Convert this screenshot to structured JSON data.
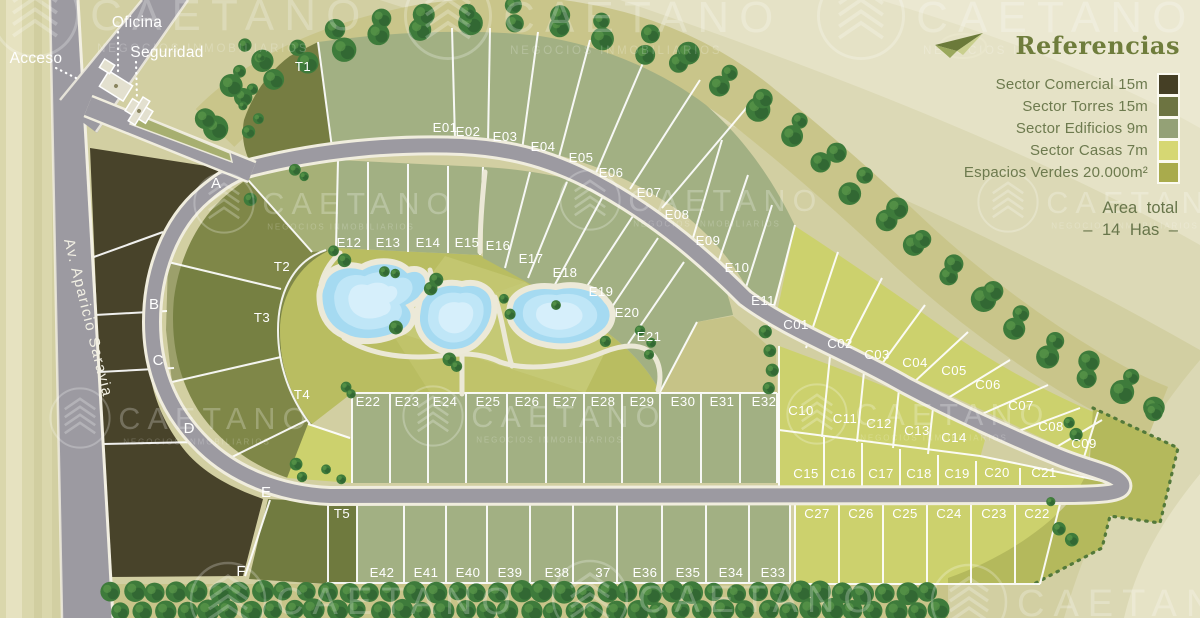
{
  "legend": {
    "title": "Referencias",
    "items": [
      {
        "label": "Sector Comercial 15m",
        "color": "#453f25"
      },
      {
        "label": "Sector Torres 15m",
        "color": "#6d7441"
      },
      {
        "label": "Sector Edificios 9m",
        "color": "#94a176"
      },
      {
        "label": "Sector Casas 7m",
        "color": "#d6d773"
      },
      {
        "label": "Espacios Verdes 20.000m²",
        "color": "#a9ab4c"
      }
    ],
    "area_line1": "Area total",
    "area_line2": "– 14 Has –"
  },
  "watermark": {
    "name": "CAETANO",
    "subtitle": "NEGOCIOS INMOBILIARIOS"
  },
  "entrance_labels": [
    {
      "text": "Acceso",
      "x": 36,
      "y": 63
    },
    {
      "text": "Oficina",
      "x": 137,
      "y": 27
    },
    {
      "text": "Seguridad",
      "x": 167,
      "y": 57
    }
  ],
  "avenue_label": {
    "text": "Av. Aparicio Saravia"
  },
  "lots": [
    {
      "id": "T1",
      "x": 303,
      "y": 71
    },
    {
      "id": "E01",
      "x": 445,
      "y": 132
    },
    {
      "id": "E02",
      "x": 468,
      "y": 136
    },
    {
      "id": "E03",
      "x": 505,
      "y": 141
    },
    {
      "id": "E04",
      "x": 543,
      "y": 151
    },
    {
      "id": "E05",
      "x": 581,
      "y": 162
    },
    {
      "id": "E06",
      "x": 611,
      "y": 177
    },
    {
      "id": "E07",
      "x": 649,
      "y": 197
    },
    {
      "id": "E08",
      "x": 677,
      "y": 219
    },
    {
      "id": "E09",
      "x": 708,
      "y": 245
    },
    {
      "id": "E10",
      "x": 737,
      "y": 272
    },
    {
      "id": "E11",
      "x": 763,
      "y": 305
    },
    {
      "id": "E12",
      "x": 349,
      "y": 247
    },
    {
      "id": "E13",
      "x": 388,
      "y": 247
    },
    {
      "id": "E14",
      "x": 428,
      "y": 247
    },
    {
      "id": "E15",
      "x": 467,
      "y": 247
    },
    {
      "id": "E16",
      "x": 498,
      "y": 250
    },
    {
      "id": "E17",
      "x": 531,
      "y": 263
    },
    {
      "id": "E18",
      "x": 565,
      "y": 277
    },
    {
      "id": "E19",
      "x": 601,
      "y": 296
    },
    {
      "id": "E20",
      "x": 627,
      "y": 317
    },
    {
      "id": "E21",
      "x": 649,
      "y": 341
    },
    {
      "id": "T2",
      "x": 282,
      "y": 271
    },
    {
      "id": "T3",
      "x": 262,
      "y": 322
    },
    {
      "id": "T4",
      "x": 302,
      "y": 399
    },
    {
      "id": "T5",
      "x": 342,
      "y": 518
    },
    {
      "id": "E22",
      "x": 368,
      "y": 406
    },
    {
      "id": "E23",
      "x": 407,
      "y": 406
    },
    {
      "id": "E24",
      "x": 445,
      "y": 406
    },
    {
      "id": "E25",
      "x": 488,
      "y": 406
    },
    {
      "id": "E26",
      "x": 527,
      "y": 406
    },
    {
      "id": "E27",
      "x": 565,
      "y": 406
    },
    {
      "id": "E28",
      "x": 603,
      "y": 406
    },
    {
      "id": "E29",
      "x": 642,
      "y": 406
    },
    {
      "id": "E30",
      "x": 683,
      "y": 406
    },
    {
      "id": "E31",
      "x": 722,
      "y": 406
    },
    {
      "id": "E32",
      "x": 764,
      "y": 406
    },
    {
      "id": "E42",
      "x": 382,
      "y": 577
    },
    {
      "id": "E41",
      "x": 426,
      "y": 577
    },
    {
      "id": "E40",
      "x": 468,
      "y": 577
    },
    {
      "id": "E39",
      "x": 510,
      "y": 577
    },
    {
      "id": "E38",
      "x": 557,
      "y": 577
    },
    {
      "id": "37",
      "x": 603,
      "y": 577
    },
    {
      "id": "E36",
      "x": 645,
      "y": 577
    },
    {
      "id": "E35",
      "x": 688,
      "y": 577
    },
    {
      "id": "E34",
      "x": 731,
      "y": 577
    },
    {
      "id": "E33",
      "x": 773,
      "y": 577
    },
    {
      "id": "C01",
      "x": 796,
      "y": 329
    },
    {
      "id": "C02",
      "x": 840,
      "y": 348
    },
    {
      "id": "C03",
      "x": 877,
      "y": 359
    },
    {
      "id": "C04",
      "x": 915,
      "y": 367
    },
    {
      "id": "C05",
      "x": 954,
      "y": 375
    },
    {
      "id": "C06",
      "x": 988,
      "y": 389
    },
    {
      "id": "C07",
      "x": 1021,
      "y": 410
    },
    {
      "id": "C08",
      "x": 1051,
      "y": 431
    },
    {
      "id": "C09",
      "x": 1084,
      "y": 448
    },
    {
      "id": "C10",
      "x": 801,
      "y": 415
    },
    {
      "id": "C11",
      "x": 845,
      "y": 423
    },
    {
      "id": "C12",
      "x": 879,
      "y": 428
    },
    {
      "id": "C13",
      "x": 917,
      "y": 435
    },
    {
      "id": "C14",
      "x": 954,
      "y": 442
    },
    {
      "id": "C15",
      "x": 806,
      "y": 478
    },
    {
      "id": "C16",
      "x": 843,
      "y": 478
    },
    {
      "id": "C17",
      "x": 881,
      "y": 478
    },
    {
      "id": "C18",
      "x": 919,
      "y": 478
    },
    {
      "id": "C19",
      "x": 957,
      "y": 478
    },
    {
      "id": "C20",
      "x": 997,
      "y": 477
    },
    {
      "id": "C21",
      "x": 1044,
      "y": 477
    },
    {
      "id": "C27",
      "x": 817,
      "y": 518
    },
    {
      "id": "C26",
      "x": 861,
      "y": 518
    },
    {
      "id": "C25",
      "x": 905,
      "y": 518
    },
    {
      "id": "C24",
      "x": 949,
      "y": 518
    },
    {
      "id": "C23",
      "x": 994,
      "y": 518
    },
    {
      "id": "C22",
      "x": 1037,
      "y": 518
    },
    {
      "id": "A",
      "x": 216,
      "y": 188
    },
    {
      "id": "B",
      "x": 154,
      "y": 309
    },
    {
      "id": "C",
      "x": 158,
      "y": 365
    },
    {
      "id": "D",
      "x": 189,
      "y": 433
    },
    {
      "id": "E",
      "x": 266,
      "y": 497
    },
    {
      "id": "F",
      "x": 241,
      "y": 576
    }
  ]
}
